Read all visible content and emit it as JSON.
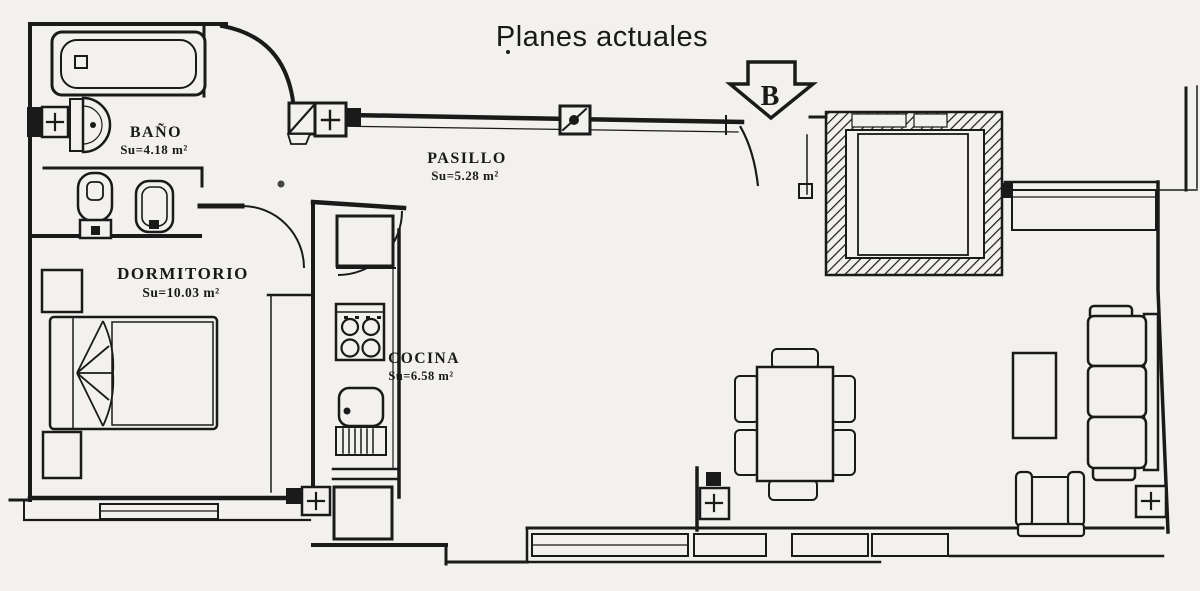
{
  "title": "Planes actuales",
  "orientation_arrow": {
    "label": "B",
    "direction": "down"
  },
  "colors": {
    "background": "#f3f1ee",
    "line": "#1a1a1a"
  },
  "rooms": [
    {
      "id": "bano",
      "name": "BAÑO",
      "area": "Su=4.18 m²"
    },
    {
      "id": "pasillo",
      "name": "PASILLO",
      "area": "Su=5.28 m²"
    },
    {
      "id": "dormitorio",
      "name": "DORMITORIO",
      "area": "Su=10.03 m²"
    },
    {
      "id": "cocina",
      "name": "COCINA",
      "area": "Su=6.58 m²"
    }
  ],
  "depicted_fixtures": [
    "bathtub",
    "washbasin",
    "toilet",
    "bidet",
    "double-bed",
    "nightstand-top",
    "nightstand-bottom",
    "fridge",
    "stove-4-burners",
    "kitchen-sink",
    "draining-board",
    "washing-machine",
    "dining-table",
    "six-chairs",
    "sofa-3-seats",
    "armchair",
    "coffee-table",
    "radiator-plus-symbols",
    "hatched-patio-shaft",
    "windows",
    "door-swing-arcs"
  ]
}
